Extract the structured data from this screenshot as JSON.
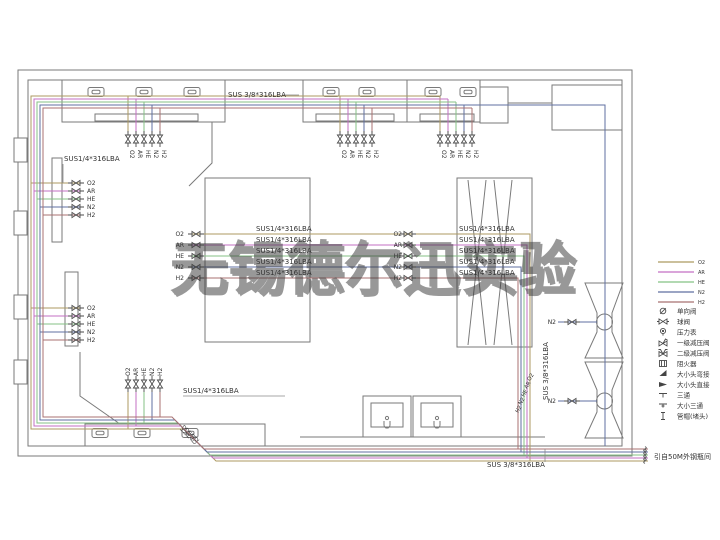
{
  "watermark": "无锡德尔迅实验",
  "pipes": {
    "label_quarter": "SUS1/4*316LBA",
    "label_threeeighth": "SUS 3/8*316LBA",
    "source_note": "引自50M外钢瓶间"
  },
  "gases": [
    {
      "code": "O2",
      "color": "#ac9a62"
    },
    {
      "code": "AR",
      "color": "#c36fc3"
    },
    {
      "code": "HE",
      "color": "#85c285"
    },
    {
      "code": "N2",
      "color": "#5f6fa0"
    },
    {
      "code": "H2",
      "color": "#a87272"
    }
  ],
  "legend": {
    "symbols": [
      {
        "name": "check-valve",
        "label": "单向阀"
      },
      {
        "name": "ball-valve",
        "label": "球阀"
      },
      {
        "name": "pressure-gauge",
        "label": "压力表"
      },
      {
        "name": "regulator-single-stage",
        "label": "一级减压阀"
      },
      {
        "name": "regulator-double-stage",
        "label": "二级减压阀"
      },
      {
        "name": "flame-arrester",
        "label": "阻火器"
      },
      {
        "name": "reducer-elbow",
        "label": "大小头弯接"
      },
      {
        "name": "reducer-straight",
        "label": "大小头直接"
      },
      {
        "name": "tee",
        "label": "三通"
      },
      {
        "name": "reducing-tee",
        "label": "大小三通"
      },
      {
        "name": "pipe-cap",
        "label": "管帽(堵头)"
      }
    ]
  }
}
